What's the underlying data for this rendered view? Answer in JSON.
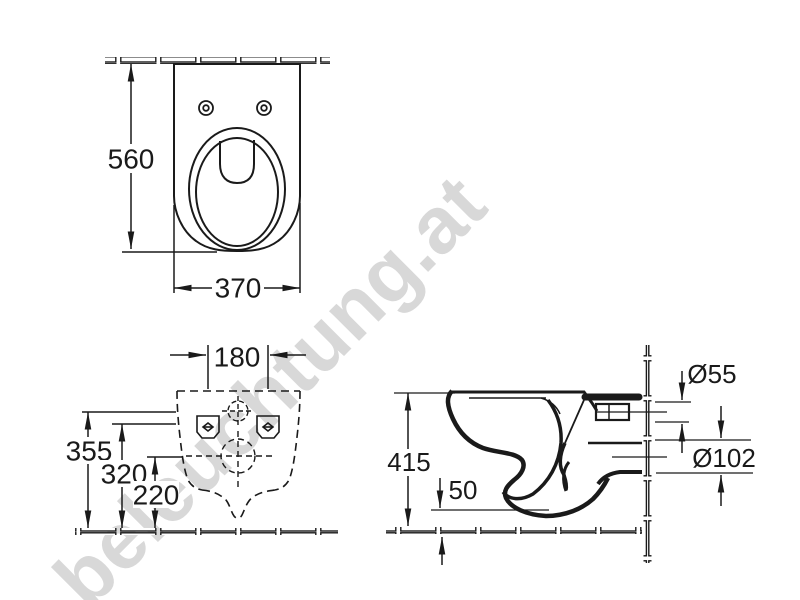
{
  "page": {
    "background": "#ffffff"
  },
  "watermark": {
    "text": "beleuchtung.at",
    "color": "#d8d8d8"
  },
  "drawing": {
    "line_color": "#1a1a1a",
    "type": "technical dimension drawing, wall-hung toilet, three orthographic views"
  },
  "labels": {
    "top_depth": "560",
    "top_width": "370",
    "rear_hole_spacing": "180",
    "rear_height_rim": "355",
    "rear_height_holes": "320",
    "rear_height_outlet": "220",
    "side_height": "415",
    "side_floor_gap": "50",
    "inlet_diameter": "Ø55",
    "outlet_diameter": "Ø102"
  }
}
